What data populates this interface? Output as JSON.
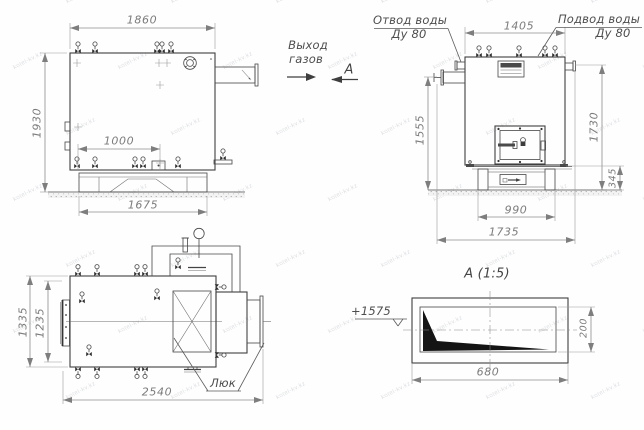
{
  "watermark": "kotel-kv.kz",
  "views": {
    "side": {
      "dims": {
        "width_top": "1860",
        "height": "1930",
        "valves_span": "1000",
        "base_width": "1675"
      },
      "gas_exit": [
        "Выход",
        "газов"
      ],
      "section_marker": "А"
    },
    "front": {
      "dims": {
        "width_top": "1405",
        "pipe_height": "1555",
        "stub_height": "1730",
        "base_height": "345",
        "base_width": "990",
        "total_width": "1735"
      },
      "water_outlet": [
        "Отвод воды",
        "Ду 80"
      ],
      "water_inlet": [
        "Подвод воды",
        "Ду 80"
      ]
    },
    "plan": {
      "dims": {
        "width_outer": "1335",
        "width_inner": "1235",
        "length": "2540"
      },
      "hatch_label": "Люк"
    },
    "section": {
      "title": "А (1:5)",
      "elevation": "+1575",
      "dims": {
        "length": "680",
        "height": "200"
      }
    }
  }
}
